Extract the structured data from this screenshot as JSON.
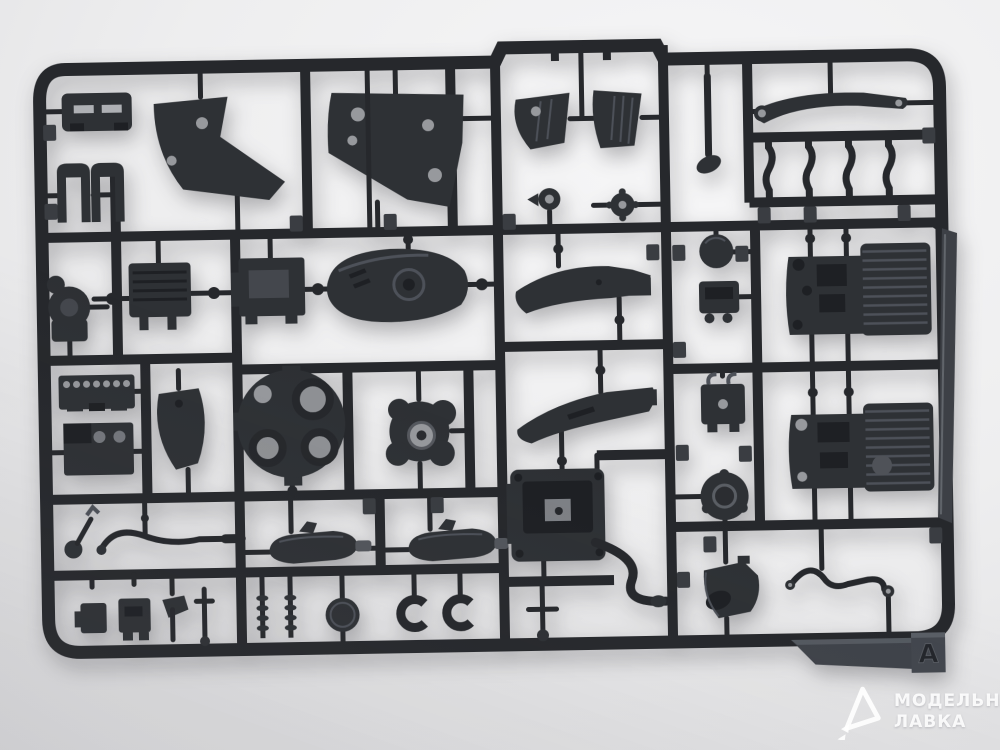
{
  "photo": {
    "description": "Dark grey injection-molded plastic sprue of motorcycle model kit parts photographed on a light studio background"
  },
  "colors": {
    "background": "#ededee",
    "background_shadow": "#cfcfd2",
    "plastic_dark": "#26282c",
    "plastic_mid": "#2e3135",
    "plastic_highlight": "#4d5159",
    "hole_light": "#97999d",
    "watermark": "#ffffff"
  },
  "sprue": {
    "brand": "MENG",
    "letter": "A"
  },
  "watermark": {
    "line1": "МОДЕЛЬНАЯ",
    "line2": "ЛАВКА"
  }
}
